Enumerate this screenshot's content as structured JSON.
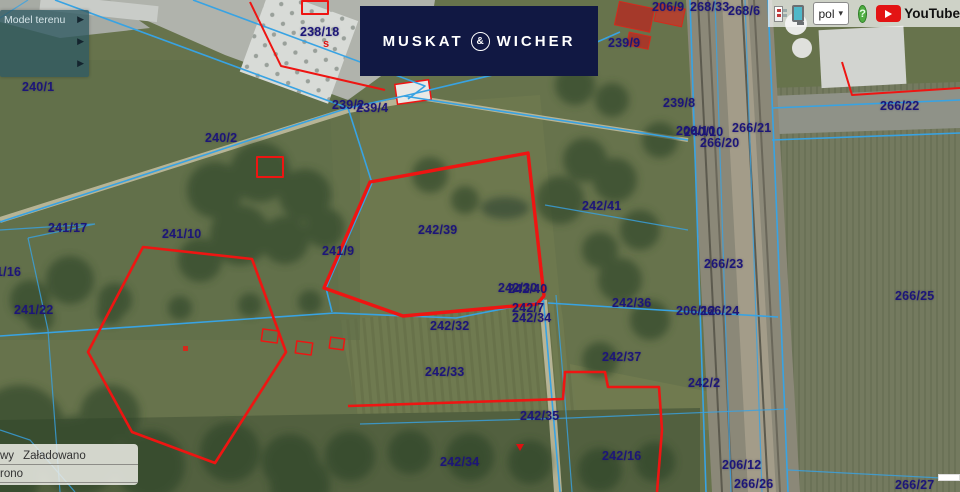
{
  "brand": {
    "banner_left": "MUSKAT",
    "banner_amp": "&",
    "banner_right": "WICHER",
    "banner_bg": "#111843"
  },
  "topbar": {
    "language_selected": "pol",
    "chevron": "▾",
    "help_glyph": "?",
    "youtube_label": "YouTube"
  },
  "layer_panel": {
    "title": "Model terenu",
    "arrow_glyph": "▶"
  },
  "status_panel": {
    "rows": [
      {
        "left": "wy",
        "right": "Załadowano"
      },
      {
        "left": "rono",
        "right": ""
      }
    ]
  },
  "map": {
    "colors": {
      "boundary_blue": "#38a3e3",
      "selection_red": "#ee1512",
      "label_navy": "#1d1678",
      "banner_navy": "#111843"
    },
    "labels": [
      {
        "t": "240/1",
        "x": 22,
        "y": 80
      },
      {
        "t": "240/2",
        "x": 205,
        "y": 131
      },
      {
        "t": "238/18",
        "x": 300,
        "y": 25
      },
      {
        "t": "239/9",
        "x": 608,
        "y": 36
      },
      {
        "t": "206/9",
        "x": 652,
        "y": 0
      },
      {
        "t": "268/33",
        "x": 690,
        "y": 0
      },
      {
        "t": "268/6",
        "x": 728,
        "y": 4
      },
      {
        "t": "239/8",
        "x": 663,
        "y": 96
      },
      {
        "t": "239/2",
        "x": 332,
        "y": 98
      },
      {
        "t": "239/4",
        "x": 356,
        "y": 101
      },
      {
        "t": "266/22",
        "x": 880,
        "y": 99
      },
      {
        "t": "206/10",
        "x": 676,
        "y": 124
      },
      {
        "t": "240/10",
        "x": 684,
        "y": 125
      },
      {
        "t": "266/21",
        "x": 732,
        "y": 121
      },
      {
        "t": "266/20",
        "x": 700,
        "y": 136
      },
      {
        "t": "241/17",
        "x": 48,
        "y": 221
      },
      {
        "t": "241/10",
        "x": 162,
        "y": 227
      },
      {
        "t": "241/9",
        "x": 322,
        "y": 244
      },
      {
        "t": "1/16",
        "x": -4,
        "y": 265
      },
      {
        "t": "241/22",
        "x": 14,
        "y": 303
      },
      {
        "t": "242/39",
        "x": 418,
        "y": 223
      },
      {
        "t": "242/41",
        "x": 582,
        "y": 199
      },
      {
        "t": "266/23",
        "x": 704,
        "y": 257
      },
      {
        "t": "242/30",
        "x": 498,
        "y": 281
      },
      {
        "t": "242/40",
        "x": 508,
        "y": 282
      },
      {
        "t": "242/7",
        "x": 512,
        "y": 301
      },
      {
        "t": "242/34",
        "x": 512,
        "y": 311
      },
      {
        "t": "242/36",
        "x": 612,
        "y": 296
      },
      {
        "t": "206/12",
        "x": 676,
        "y": 304
      },
      {
        "t": "266/24",
        "x": 700,
        "y": 304
      },
      {
        "t": "266/25",
        "x": 895,
        "y": 289
      },
      {
        "t": "242/32",
        "x": 430,
        "y": 319
      },
      {
        "t": "242/33",
        "x": 425,
        "y": 365
      },
      {
        "t": "242/37",
        "x": 602,
        "y": 350
      },
      {
        "t": "242/2",
        "x": 688,
        "y": 376
      },
      {
        "t": "242/35",
        "x": 520,
        "y": 409
      },
      {
        "t": "242/16",
        "x": 602,
        "y": 449
      },
      {
        "t": "242/34",
        "x": 440,
        "y": 455
      },
      {
        "t": "206/12",
        "x": 722,
        "y": 458
      },
      {
        "t": "266/26",
        "x": 734,
        "y": 477
      },
      {
        "t": "266/27",
        "x": 895,
        "y": 478
      }
    ],
    "red_marks": [
      {
        "t": "s",
        "x": 323,
        "y": 38
      }
    ]
  }
}
